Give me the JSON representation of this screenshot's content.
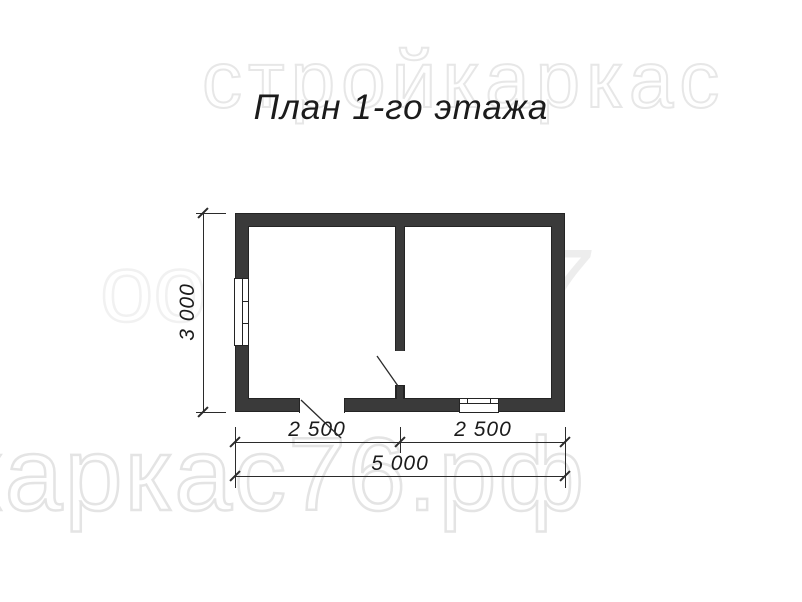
{
  "title": "План 1-го этажа",
  "dimensions": {
    "height": "3 000",
    "bottom_left": "2 500",
    "bottom_right": "2 500",
    "bottom_total": "5 000"
  },
  "watermarks": {
    "top": "стройкаркас",
    "middle_left": "оо",
    "middle_right": "7",
    "bottom": "каркас76.рф"
  },
  "colors": {
    "bg": "#ffffff",
    "wall": "#3a3a3a",
    "wall-outline": "#242424",
    "draw-line": "#2b2b2b",
    "text": "#1b1b1b",
    "wm-stroke": "#e7e7e7",
    "wm-fill": "#ededed"
  },
  "plan": {
    "rooms": [
      {
        "id": "room-left"
      },
      {
        "id": "room-right"
      }
    ],
    "features": [
      {
        "type": "window",
        "location": "left-exterior-wall"
      },
      {
        "type": "window",
        "location": "bottom-exterior-wall-right-room"
      },
      {
        "type": "door",
        "location": "bottom-exterior-wall-left-room",
        "swing": "outward"
      },
      {
        "type": "door",
        "location": "interior-partition-wall",
        "swing": "into-left-room"
      }
    ]
  }
}
